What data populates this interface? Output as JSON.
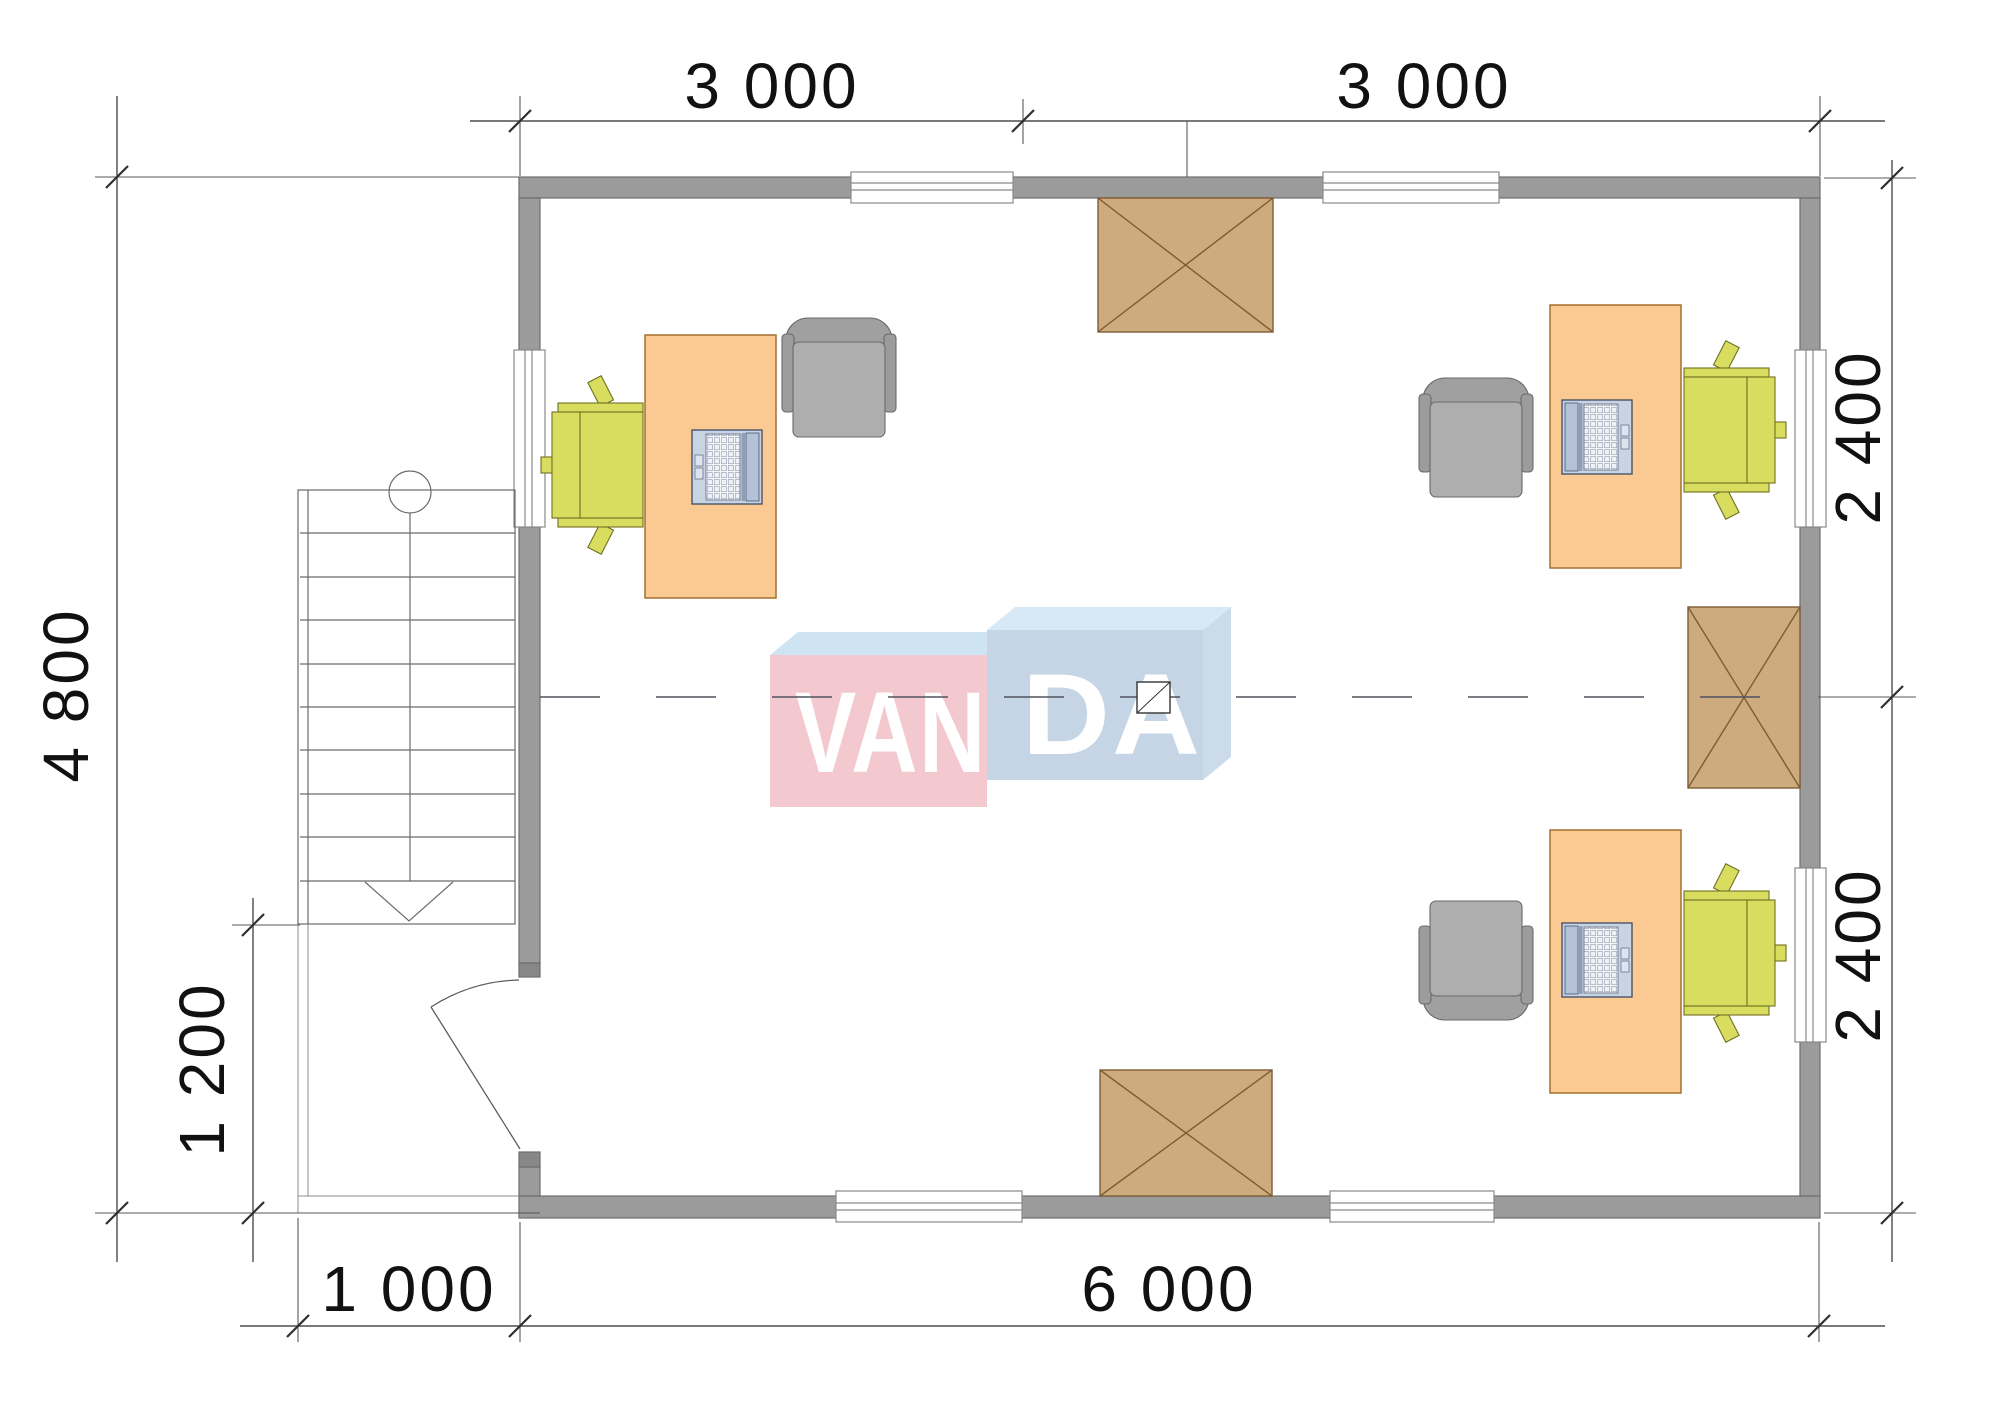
{
  "document": {
    "type": "architectural floor plan",
    "brand": "VANDA"
  },
  "dimensions": {
    "top": [
      "3 000",
      "3 000"
    ],
    "right": [
      "2 400",
      "2 400"
    ],
    "left": {
      "total": "4 800",
      "porch": "1 200"
    },
    "bottom": {
      "porch": "1 000",
      "total": "6 000"
    }
  },
  "watermark": {
    "left": "VAN",
    "right": "DA",
    "brand": "VANDA"
  },
  "inventory": {
    "workstations": 3,
    "desks": 3,
    "task_chairs": 3,
    "armchairs": 3,
    "laptops": 3,
    "heaters": 3,
    "windows": 7,
    "doors": 1,
    "staircases": 1
  },
  "colors": {
    "wall": "#9b9b9b",
    "wall_jamb": "#878787",
    "desk": "#fbca92",
    "task_chair": "#d9dd5f",
    "armchair": "#a9a9a9",
    "laptop": "#c8d3e3",
    "heater": "#cdab7e",
    "heater_line": "#7d5c33",
    "dimension_line": "#4d4d4d",
    "text": "#111111",
    "watermark_pink": "#f3c8ce",
    "watermark_pink_top": "#cfe4f3",
    "watermark_blue": "#c5d5e5",
    "watermark_blue_top": "#d7e9f7",
    "watermark_blue_side": "#cbdbea",
    "watermark_text": "#ffffff"
  }
}
